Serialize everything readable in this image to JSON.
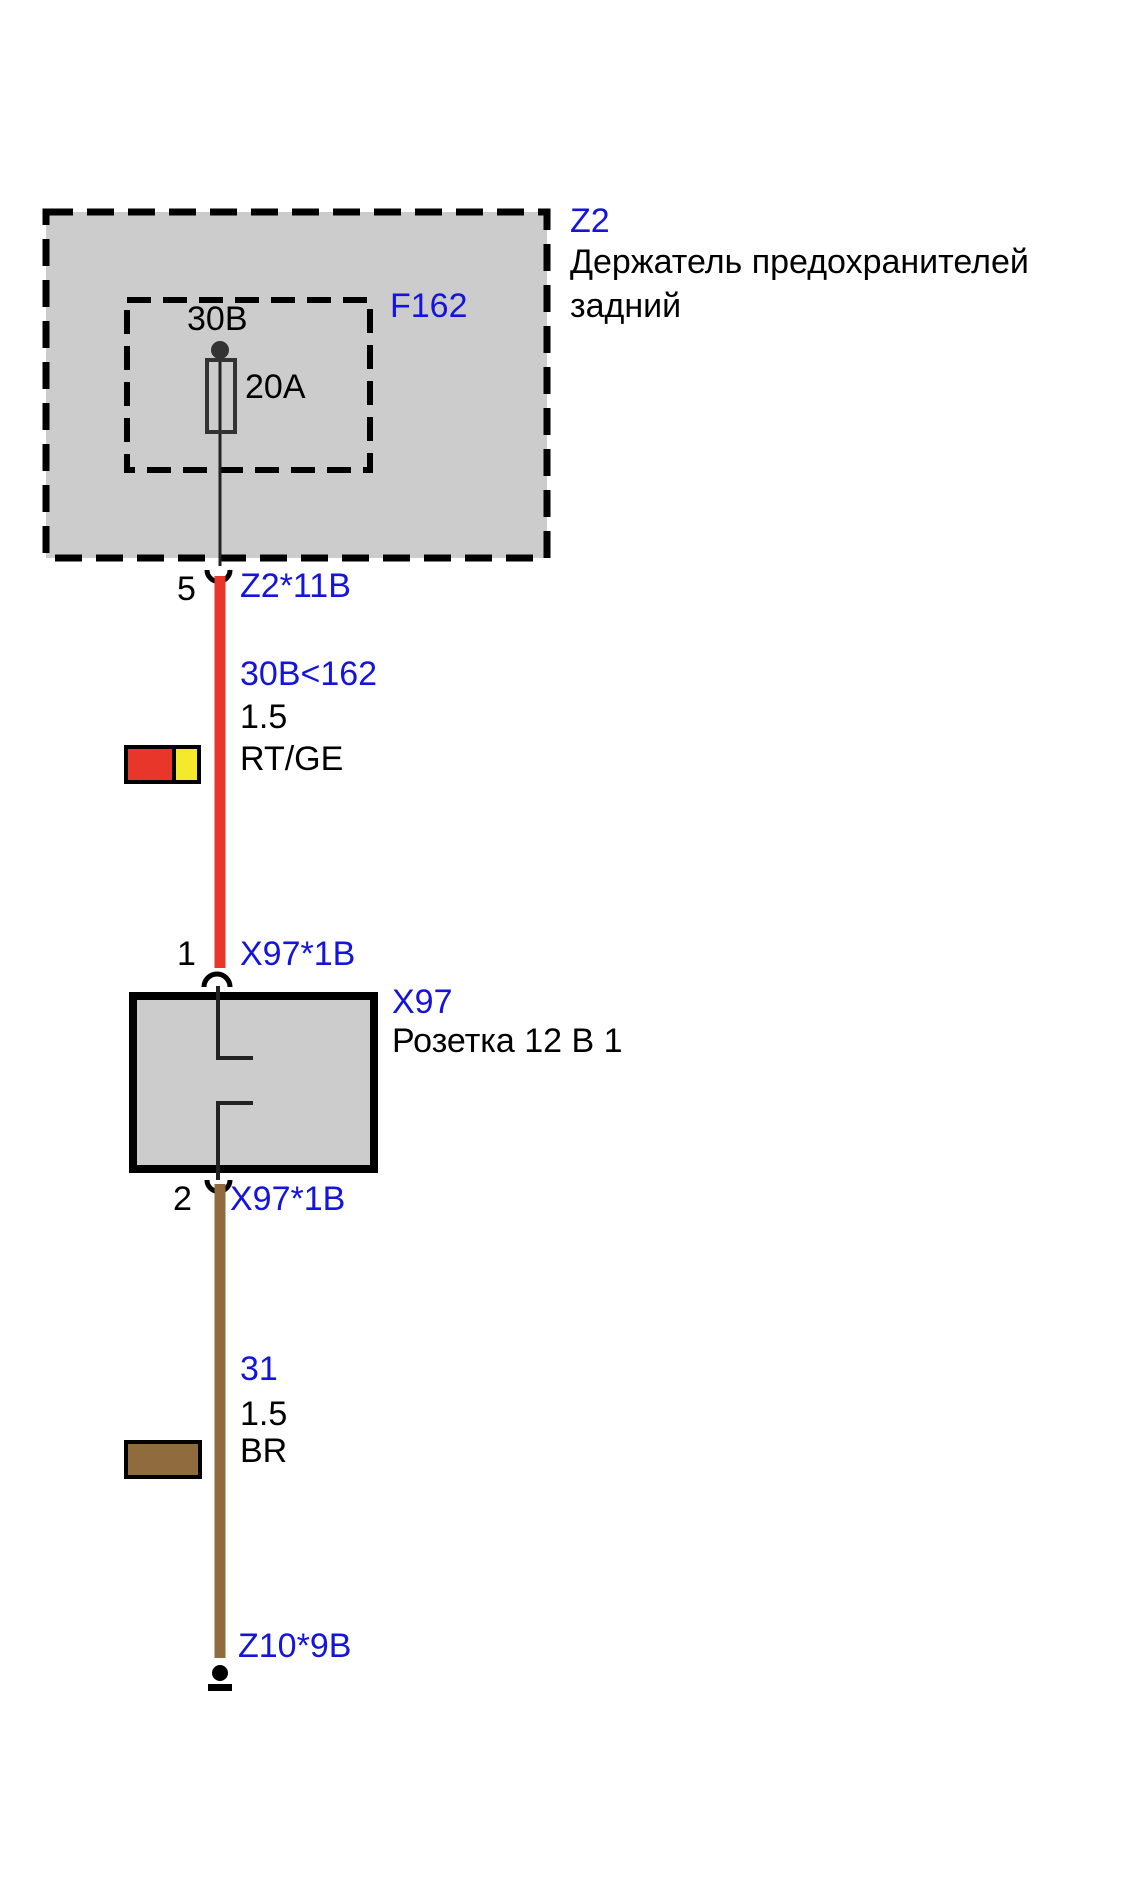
{
  "colors": {
    "label_blue": "#1414dd",
    "wire_red": "#e8362a",
    "wire_yellow": "#f5e92c",
    "wire_brown": "#8f6b3e",
    "component_fill": "#cccccc"
  },
  "fuse_holder": {
    "ref": "Z2",
    "name_line1": "Держатель предохранителей",
    "name_line2": "задний",
    "fuse_ref": "F162",
    "fuse_source": "30B",
    "fuse_rating": "20A",
    "pin": "5",
    "pin_connector": "Z2*11B"
  },
  "wire_power": {
    "circuit": "30B<162",
    "gauge": "1.5",
    "color_code": "RT/GE"
  },
  "socket": {
    "ref": "X97",
    "name": "Розетка 12 В 1",
    "pin_in": "1",
    "pin_in_connector": "X97*1B",
    "pin_out": "2",
    "pin_out_connector": "X97*1B"
  },
  "wire_ground": {
    "circuit": "31",
    "gauge": "1.5",
    "color_code": "BR"
  },
  "ground_connector": "Z10*9B"
}
